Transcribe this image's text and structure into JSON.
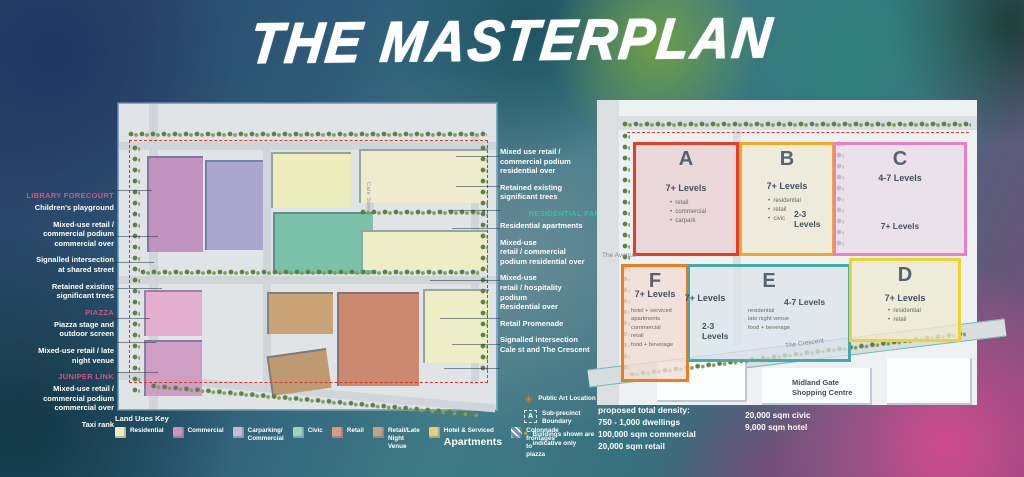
{
  "title": "THE MASTERPLAN",
  "colors": {
    "annotation_heading_pink": "#cb5584",
    "annotation_heading_teal": "#2fc3a0",
    "annotation_text": "#ffffff",
    "site_boundary_red": "#d8362a",
    "public_art_orange": "#f0841f"
  },
  "left_annotations": {
    "groups": [
      {
        "heading": "LIBRARY FORECOURT",
        "items": [
          "Children's playground",
          "Mixed-use retail /\ncommercial podium\ncommercial over",
          "Signalled intersection\nat shared street",
          "Retained existing\nsignificant trees"
        ]
      },
      {
        "heading": "PIAZZA",
        "items": [
          "Piazza stage and\noutdoor screen",
          "Mixed-use retail / late\nnight venue"
        ]
      },
      {
        "heading": "JUNIPER LINK",
        "items": [
          "Mixed-use retail /\ncommercial podium\ncommercial over",
          "Taxi rank"
        ]
      }
    ]
  },
  "middle_annotations": {
    "items": [
      {
        "text": "Mixed use retail /\ncommercial podium\nresidential over"
      },
      {
        "text": "Retained existing\nsignificant trees"
      },
      {
        "heading": true,
        "text": "RESIDENTIAL PARK"
      },
      {
        "text": "Residential apartments"
      },
      {
        "text": "Mixed-use\nretail / commercial\npodium residential over"
      },
      {
        "text": "Mixed-use\nretail / hospitality\npodium\nResidential over"
      },
      {
        "text": "Retail Promenade"
      },
      {
        "text": "Signalled intersection\nCale st and The Crescent"
      }
    ]
  },
  "left_map": {
    "street_label": "Cale Street"
  },
  "right_map": {
    "precincts": [
      {
        "id": "A",
        "letter": "A",
        "outline": "#e63c2a",
        "levels": "7+ Levels",
        "bullets": [
          "retail",
          "commercial",
          "carpark"
        ]
      },
      {
        "id": "B",
        "letter": "B",
        "outline": "#f5a91f",
        "levels": "7+ Levels",
        "bullets": [
          "residential",
          "retail",
          "civic"
        ],
        "sub_levels": "2-3\nLevels"
      },
      {
        "id": "C",
        "letter": "C",
        "outline": "#ea7fc2",
        "levels": "4-7 Levels",
        "sub_levels": "7+ Levels"
      },
      {
        "id": "F",
        "letter": "F",
        "outline": "#f07c22",
        "levels": "7+ Levels",
        "list": "hotel + serviced\napartments\ncommercial\nretail\nfood + beverage"
      },
      {
        "id": "E",
        "letter": "E",
        "outline": "#49a9a4",
        "levels": "7+ Levels",
        "mid_levels": "4-7 Levels",
        "sub_levels": "2-3\nLevels",
        "list": "residential\nlate night venue\nfood + beverage"
      },
      {
        "id": "D",
        "letter": "D",
        "outline": "#f2d22e",
        "levels": "7+ Levels",
        "bullets": [
          "residential",
          "retail"
        ]
      }
    ],
    "roads": {
      "avenue": "The Avenue",
      "crescent": "The Crescent",
      "shopping_centre": "Midland Gate\nShopping Centre"
    }
  },
  "legend": {
    "title": "Land Uses Key",
    "items": [
      {
        "label": "Residential",
        "color": "#f0eebb"
      },
      {
        "label": "Commercial",
        "color": "#cf93bb"
      },
      {
        "label": "Carparking/\nCommercial",
        "color": "#c3bcd9"
      },
      {
        "label": "Civic",
        "color": "#9fd4b4"
      },
      {
        "label": "Retail",
        "color": "#e09a82"
      },
      {
        "label": "Retail/Late Night\nVenue",
        "color": "#c3a284"
      },
      {
        "label": "Hotel & Serviced",
        "label2": "Apartments",
        "color": "#e8cc7a"
      },
      {
        "label": "Colonnade frontages to\npiazza",
        "color": "hatch"
      }
    ]
  },
  "notes": {
    "public_art": "Public Art Location",
    "sub_precinct_letter": "A",
    "sub_precinct": "Sub-precinct\nBoundary",
    "indicative_prefix": "*",
    "indicative": "Buildings shown are\nindicative only"
  },
  "density": {
    "left": [
      "proposed total density:",
      "750 - 1,000 dwellings",
      "100,000 sqm commercial",
      "20,000 sqm retail"
    ],
    "right": [
      "20,000 sqm civic",
      "9,000 sqm hotel"
    ]
  }
}
